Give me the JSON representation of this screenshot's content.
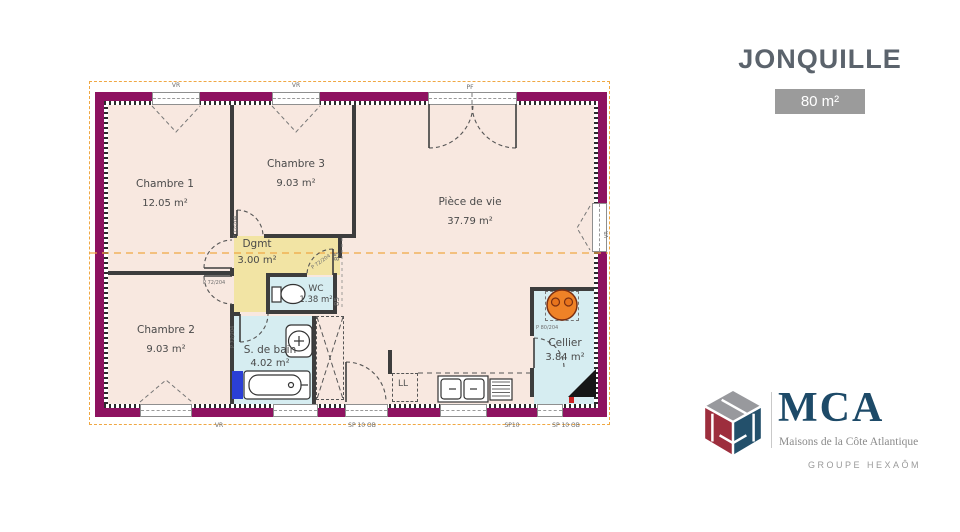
{
  "header": {
    "title": "JONQUILLE",
    "area_badge": "80 m²"
  },
  "rooms": {
    "chambre1": {
      "name": "Chambre 1",
      "area": "12.05 m²"
    },
    "chambre3": {
      "name": "Chambre 3",
      "area": "9.03 m²"
    },
    "piece_de_vie": {
      "name": "Pièce de vie",
      "area": "37.79 m²"
    },
    "dgmt": {
      "name": "Dgmt",
      "area": "3.00 m²"
    },
    "wc": {
      "name": "WC",
      "area": "1.38 m²"
    },
    "chambre2": {
      "name": "Chambre 2",
      "area": "9.03 m²"
    },
    "salle_de_bain": {
      "name": "S. de bain",
      "area": "4.02 m²"
    },
    "cellier": {
      "name": "Cellier",
      "area": "3.84 m²"
    }
  },
  "ann": {
    "window_top_1": "VR",
    "window_top_2": "VR",
    "window_top_3": "PF",
    "window_bottom_1": "VR",
    "window_bottom_2": "SP 10 OB",
    "window_bottom_3": "SP10",
    "window_bottom_4": "SP 10 OB",
    "window_right": "VR",
    "door_label": "P 72/204",
    "cellier_door_label": "P 80/204",
    "dim": "85",
    "washing_machine": "LL"
  },
  "logo": {
    "name": "MCA",
    "tagline": "Maisons de la Côte Atlantique",
    "group": "GROUPE HEXAÔM"
  },
  "colors": {
    "wall": "#8e1260",
    "room_pink": "#f8e8e0",
    "hall_yellow": "#f2e4a4",
    "wet_blue": "#d6edf1",
    "orange_dash": "#f0a843",
    "heater_orange": "#ef8227",
    "title_gray": "#5b636c",
    "brand_navy": "#1d4a68",
    "brand_red": "#9d2e3d"
  }
}
